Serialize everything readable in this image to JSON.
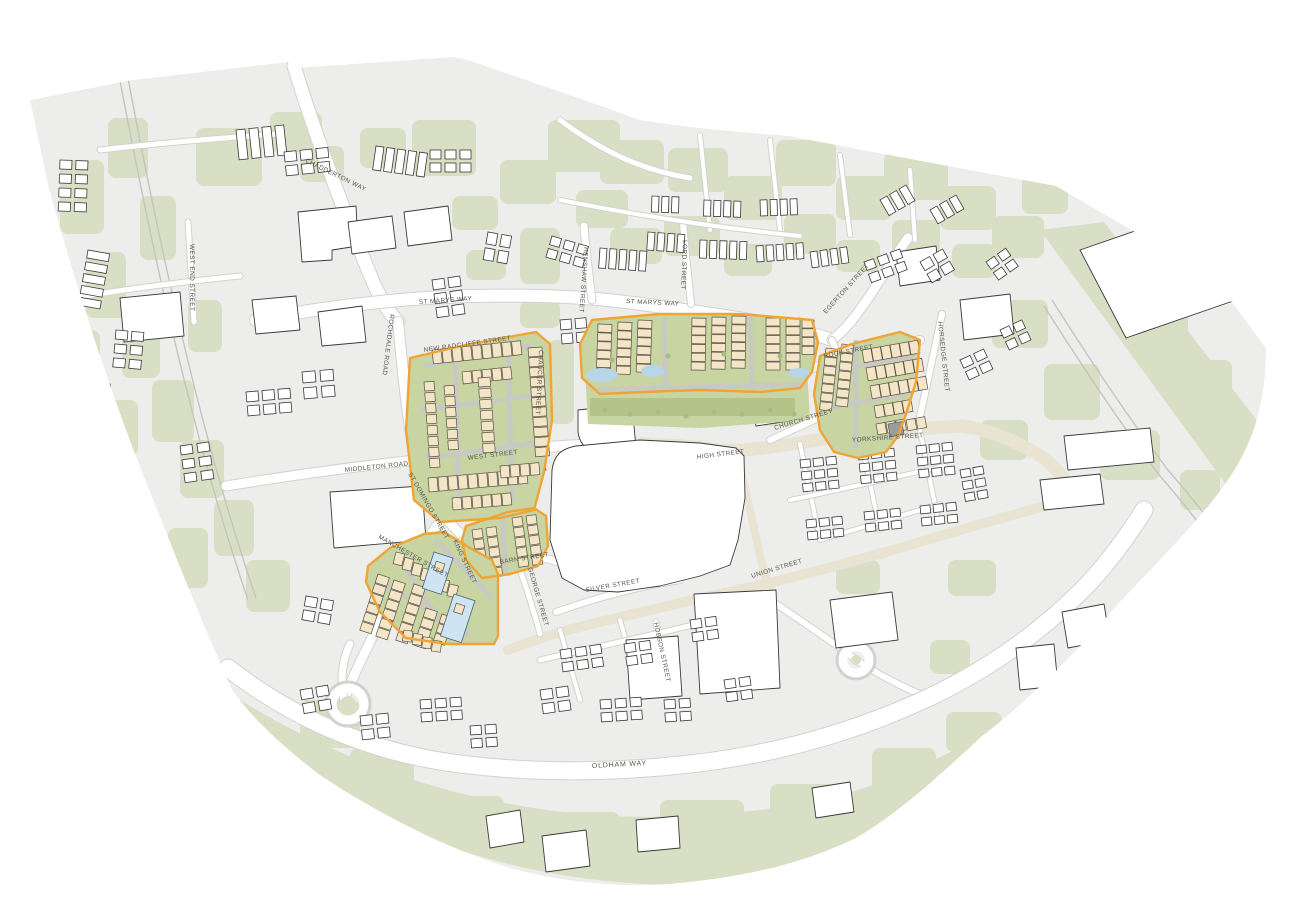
{
  "map": {
    "kind": "town-centre-masterplan-site-plan",
    "street_labels": [
      {
        "id": "chadderton-way",
        "label": "CHADDERTON WAY"
      },
      {
        "id": "west-end-street",
        "label": "WEST END STREET"
      },
      {
        "id": "st-marys-way-west",
        "label": "ST MARYS WAY"
      },
      {
        "id": "st-marys-way-east",
        "label": "ST MARYS WAY"
      },
      {
        "id": "henshaw-street",
        "label": "HENSHAW STREET"
      },
      {
        "id": "lord-street",
        "label": "LORD STREET"
      },
      {
        "id": "egerton-street",
        "label": "EGERTON STREET"
      },
      {
        "id": "rochdale-road",
        "label": "ROCHDALE ROAD"
      },
      {
        "id": "new-radcliffe-street",
        "label": "NEW RADCLIFFE STREET"
      },
      {
        "id": "chaucer-street",
        "label": "CHAUCER STREET"
      },
      {
        "id": "west-street",
        "label": "WEST STREET"
      },
      {
        "id": "middleton-road",
        "label": "MIDDLETON ROAD"
      },
      {
        "id": "st-domingo-street",
        "label": "ST DOMINGO STREET"
      },
      {
        "id": "manchester-street",
        "label": "MANCHESTER STREET"
      },
      {
        "id": "king-street",
        "label": "KING STREET"
      },
      {
        "id": "barn-street",
        "label": "BARN STREET"
      },
      {
        "id": "george-street",
        "label": "GEORGE STREET"
      },
      {
        "id": "silver-street",
        "label": "SILVER STREET"
      },
      {
        "id": "hobson-street",
        "label": "HOBSON STREET"
      },
      {
        "id": "union-street",
        "label": "UNION STREET"
      },
      {
        "id": "high-street",
        "label": "HIGH STREET"
      },
      {
        "id": "church-street",
        "label": "CHURCH STREET"
      },
      {
        "id": "yorkshire-street",
        "label": "YORKSHIRE STREET"
      },
      {
        "id": "rock-street",
        "label": "ROCK STREET"
      },
      {
        "id": "horsedge-street",
        "label": "HORSEDGE STREET"
      },
      {
        "id": "oldham-way",
        "label": "OLDHAM WAY"
      }
    ],
    "colors": {
      "base": "#ededeb",
      "greenspace": "#d9dfc5",
      "site_green": "#c8d4a2",
      "site_green_strip": "#b4c489",
      "road_white": "#ffffff",
      "road_casing": "#d2d2cf",
      "road_beige": "#e9e3d2",
      "building_fill": "#ffffff",
      "building_outline": "#3a3a3a",
      "site_building": "#f3e5c6",
      "site_building_outline": "#565249",
      "site_boundary_orange": "#f0a435",
      "water": "#b7d6e9",
      "blue_building": "#cfe4f2",
      "gray_building": "#9c9c9a",
      "label_text": "#55554f"
    }
  }
}
